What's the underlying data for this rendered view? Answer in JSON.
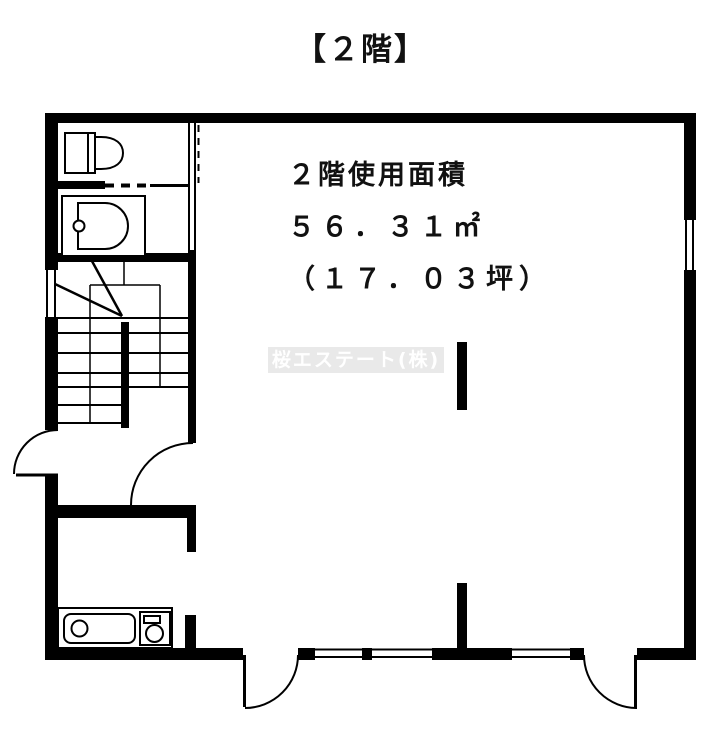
{
  "page": {
    "background": "#ffffff"
  },
  "title": "【２階】",
  "area_info": {
    "line1": "２階使用面積",
    "line2": "５６．３１㎡",
    "line3": "（１７．０３坪）"
  },
  "watermark": {
    "text": "桜エステート(株)",
    "bg_color": "#e9e9e9",
    "text_color": "#ffffff"
  },
  "colors": {
    "wall": "#000000",
    "line": "#000000",
    "background": "#ffffff"
  },
  "fixtures": [
    "toilet",
    "vanity-sink",
    "staircase-with-up-arrow",
    "kitchen-sink",
    "gas-stove",
    "hinged-door-swing",
    "sliding-window"
  ]
}
